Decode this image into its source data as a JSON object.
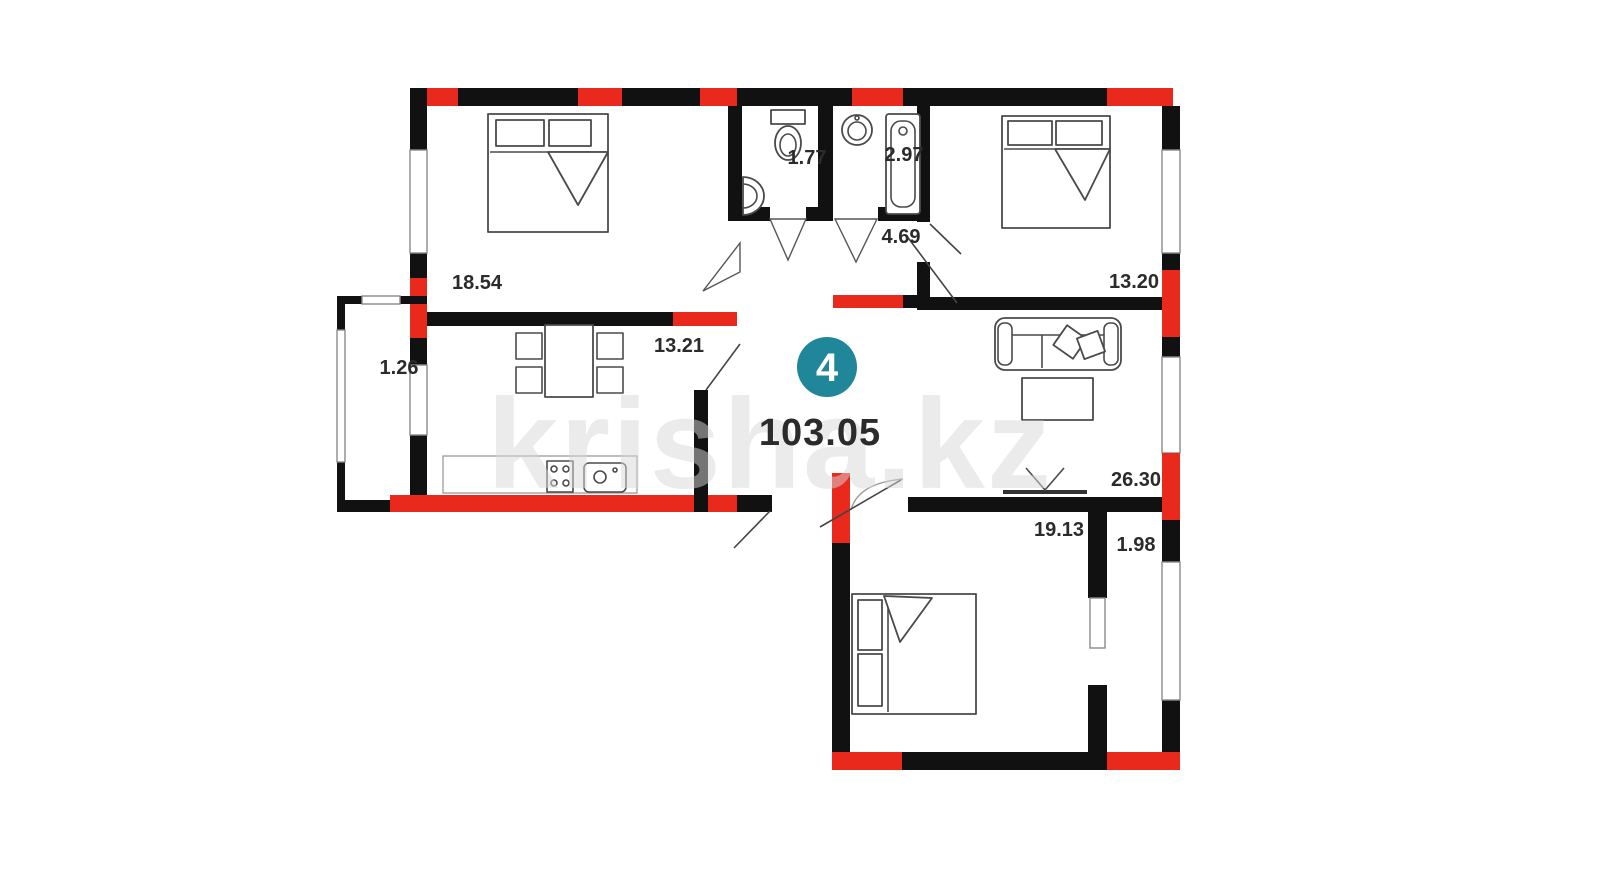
{
  "plan": {
    "unit_badge": {
      "number": "4",
      "color": "#1f8799"
    },
    "total_area": "103.05",
    "watermark": "krisha.kz",
    "colors": {
      "wall": "#111111",
      "accent_red": "#e8291c",
      "label_text": "#2b2b2b",
      "furniture_stroke": "#4a4a4a"
    },
    "rooms": [
      {
        "name": "bedroom-top-left",
        "area": "18.54"
      },
      {
        "name": "kitchen",
        "area": "13.21"
      },
      {
        "name": "balcony",
        "area": "1.26"
      },
      {
        "name": "wc",
        "area": "1.77"
      },
      {
        "name": "bathroom",
        "area": "2.97"
      },
      {
        "name": "hallway",
        "area": "4.69"
      },
      {
        "name": "bedroom-top-right",
        "area": "13.20"
      },
      {
        "name": "living-room",
        "area": "26.30"
      },
      {
        "name": "bedroom-bottom",
        "area": "19.13"
      },
      {
        "name": "storage",
        "area": "1.98"
      }
    ]
  }
}
